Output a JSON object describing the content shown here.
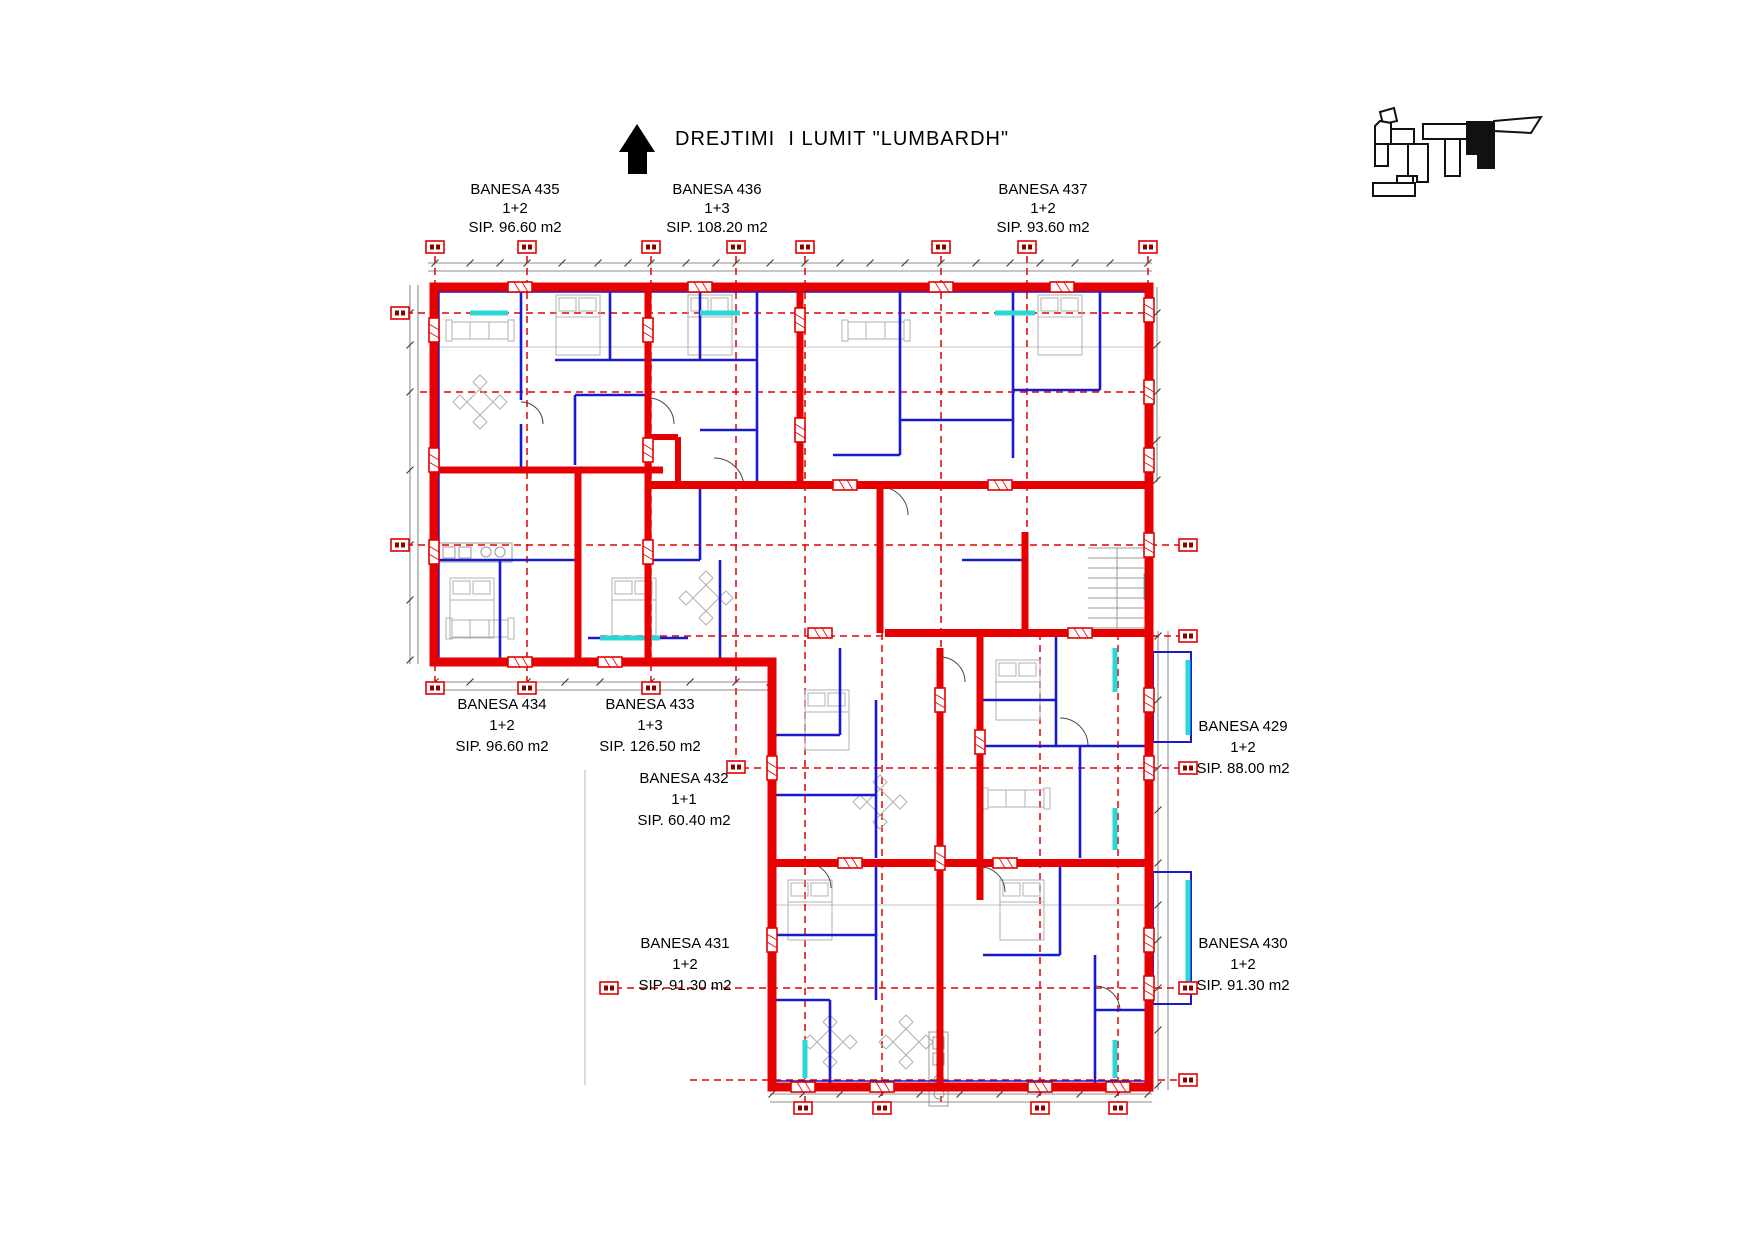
{
  "title": "DREJTIMI  I LUMIT \"LUMBARDH\"",
  "north_arrow_icon": "up-arrow",
  "key_plan": {
    "description": "site key plan, current block filled black"
  },
  "apartments": [
    {
      "name": "BANESA 435",
      "type": "1+2",
      "area": "SIP. 96.60 m2"
    },
    {
      "name": "BANESA 436",
      "type": "1+3",
      "area": "SIP. 108.20 m2"
    },
    {
      "name": "BANESA 437",
      "type": "1+2",
      "area": "SIP. 93.60 m2"
    },
    {
      "name": "BANESA 434",
      "type": "1+2",
      "area": "SIP. 96.60 m2"
    },
    {
      "name": "BANESA 433",
      "type": "1+3",
      "area": "SIP. 126.50 m2"
    },
    {
      "name": "BANESA 432",
      "type": "1+1",
      "area": "SIP. 60.40 m2"
    },
    {
      "name": "BANESA 431",
      "type": "1+2",
      "area": "SIP. 91.30 m2"
    },
    {
      "name": "BANESA 429",
      "type": "1+2",
      "area": "SIP. 88.00 m2"
    },
    {
      "name": "BANESA 430",
      "type": "1+2",
      "area": "SIP. 91.30 m2"
    }
  ],
  "colors": {
    "wall": "#e60000",
    "partition": "#1a1acd",
    "window": "#2bd6d6",
    "axis": "#e60000",
    "dimension": "#666666",
    "furniture": "#b0b0b0",
    "keyplan": "#111111"
  }
}
